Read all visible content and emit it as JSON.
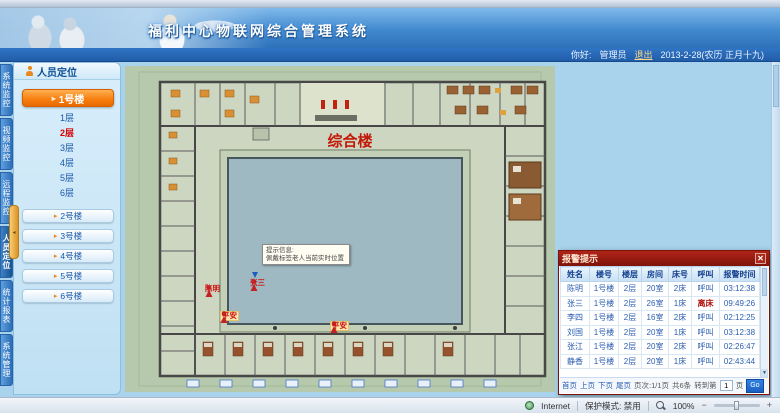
{
  "header": {
    "title": "福利中心物联网综合管理系统",
    "greeting_label": "你好:",
    "username": "管理员",
    "logout_label": "退出",
    "date_text": "2013-2-28(农历 正月十九)"
  },
  "nav_tabs": [
    {
      "label": "系统监控"
    },
    {
      "label": "视频监控"
    },
    {
      "label": "远程监控"
    },
    {
      "label": "人员定位",
      "active": true
    },
    {
      "label": "统计报表"
    },
    {
      "label": "系统管理"
    }
  ],
  "sidebar": {
    "panel_title": "人员定位",
    "active_building": "1号楼",
    "floors": [
      {
        "label": "1层"
      },
      {
        "label": "2层",
        "active": true
      },
      {
        "label": "3层"
      },
      {
        "label": "4层"
      },
      {
        "label": "5层"
      },
      {
        "label": "6层"
      }
    ],
    "buildings": [
      {
        "label": "2号楼"
      },
      {
        "label": "3号楼"
      },
      {
        "label": "4号楼"
      },
      {
        "label": "5号楼"
      },
      {
        "label": "6号楼"
      }
    ]
  },
  "floorplan": {
    "building_label": "综合楼",
    "tooltip_line1": "提示信息:",
    "tooltip_line2": "佩戴标签老人当前实时位置",
    "markers": [
      {
        "name": "陈明"
      },
      {
        "name": "张三"
      },
      {
        "name": "平安"
      },
      {
        "name": "平安"
      }
    ]
  },
  "alarm_panel": {
    "title": "报警提示",
    "close_label": "✕",
    "columns": [
      "姓名",
      "楼号",
      "楼层",
      "房间",
      "床号",
      "呼叫",
      "报警时间"
    ],
    "rows": [
      [
        "陈明",
        "1号楼",
        "2层",
        "20室",
        "2床",
        "呼叫",
        "03:12:38"
      ],
      [
        "张三",
        "1号楼",
        "2层",
        "26室",
        "1床",
        "离床",
        "09:49:26"
      ],
      [
        "李四",
        "1号楼",
        "2层",
        "16室",
        "2床",
        "呼叫",
        "02:12:25"
      ],
      [
        "刘国",
        "1号楼",
        "2层",
        "20室",
        "1床",
        "呼叫",
        "03:12:38"
      ],
      [
        "张江",
        "1号楼",
        "2层",
        "20室",
        "2床",
        "呼叫",
        "02:26:47"
      ],
      [
        "静香",
        "1号楼",
        "2层",
        "20室",
        "1床",
        "呼叫",
        "02:43:44"
      ]
    ],
    "pagination": {
      "first": "首页",
      "prev": "上页",
      "next": "下页",
      "last": "尾页",
      "page_info": "页次:1/1页",
      "total": "共6条",
      "goto_prefix": "转到第",
      "goto_suffix": "页",
      "goto_value": "1",
      "go_label": "Go"
    }
  },
  "statusbar": {
    "zone": "Internet",
    "protected_mode": "保护模式: 禁用",
    "zoom_level": "100%"
  },
  "colors": {
    "accent_orange": "#f07d0d",
    "alarm_red": "#8e1309",
    "header_blue": "#3d85cc",
    "table_text": "#2a5db0",
    "plan_green": "#b6c9ac",
    "courtyard_blue": "#9fb9c3"
  }
}
